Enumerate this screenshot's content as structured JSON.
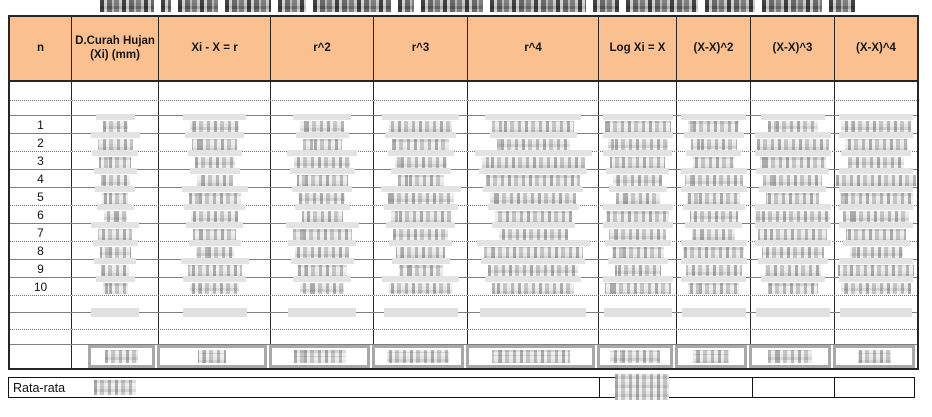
{
  "title": {
    "redacted": true
  },
  "table": {
    "columns": [
      "n",
      "D.Curah Hujan (Xi) (mm)",
      "Xi - X = r",
      "r^2",
      "r^3",
      "r^4",
      "Log Xi = X",
      "(X-X)^2",
      "(X-X)^3",
      "(X-X)^4"
    ],
    "row_numbers": [
      "1",
      "2",
      "3",
      "4",
      "5",
      "6",
      "7",
      "8",
      "9",
      "10"
    ],
    "values_redacted": true,
    "totals_row_redacted": true
  },
  "footer": {
    "label": "Rata-rata",
    "average_values_redacted": true
  },
  "colors": {
    "header_bg": "#FAC090",
    "grid_dark": "#262626",
    "grid_gray": "#7F7F7F",
    "totals_box_border": "#A8A8A8",
    "redaction_fill": "#D9D9D9",
    "redaction_light": "#E3E3E3"
  }
}
